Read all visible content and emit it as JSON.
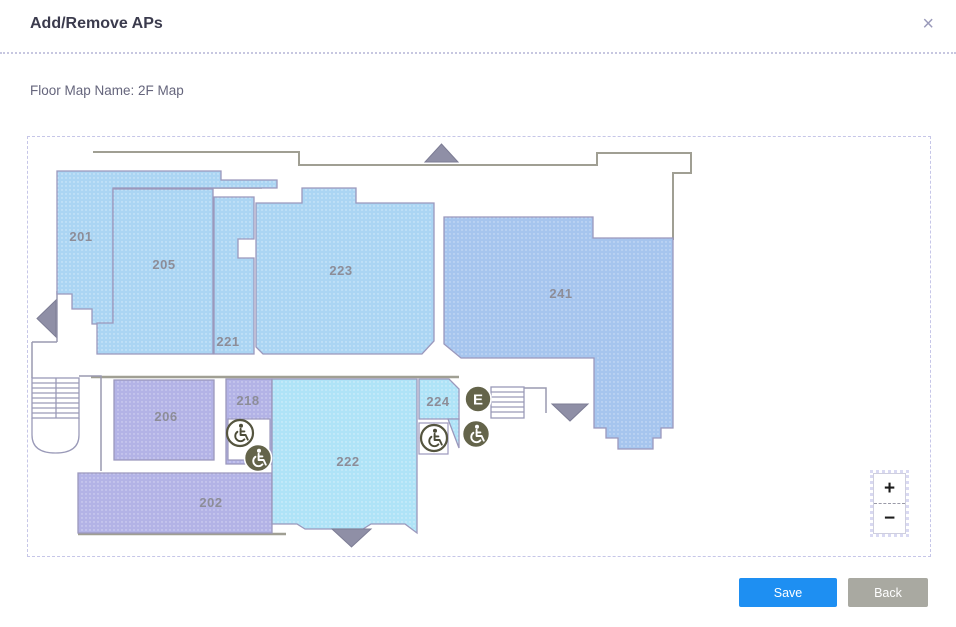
{
  "header": {
    "title": "Add/Remove APs",
    "close_icon": "×"
  },
  "info": {
    "floor_map_label": "Floor Map Name: 2F Map"
  },
  "map": {
    "name": "2F Map",
    "elevator_letter": "E",
    "rooms": [
      {
        "label": "201",
        "color": "#abd5f3"
      },
      {
        "label": "205",
        "color": "#abd5f3"
      },
      {
        "label": "221",
        "color": "#abd5f3"
      },
      {
        "label": "223",
        "color": "#abd5f3"
      },
      {
        "label": "241",
        "color": "#a6c5ee"
      },
      {
        "label": "206",
        "color": "#b3b3e6"
      },
      {
        "label": "218",
        "color": "#b3b3e6"
      },
      {
        "label": "224",
        "color": "#afe3f7"
      },
      {
        "label": "222",
        "color": "#afe3f7"
      },
      {
        "label": "202",
        "color": "#b3b3e6"
      }
    ],
    "icons": {
      "elevator": "elevator-icon",
      "accessible": "wheelchair-accessible-icon",
      "arrows": [
        "up-arrow",
        "left-arrow",
        "down-arrow",
        "down-arrow"
      ]
    },
    "zoom": {
      "zoom_in": "+",
      "zoom_out": "−"
    }
  },
  "footer": {
    "save": "Save",
    "back": "Back"
  },
  "colors": {
    "accent_blue": "#1e8ff2",
    "back_gray": "#a9a9a1",
    "room_blue": "#abd5f3",
    "room_blue_dark": "#a6c5ee",
    "room_cyan": "#afe3f7",
    "room_lavender": "#b3b3e6",
    "olive_icon": "#64644a",
    "wall_gray": "#a09f93",
    "arrow_gray": "#8f8fa6"
  }
}
